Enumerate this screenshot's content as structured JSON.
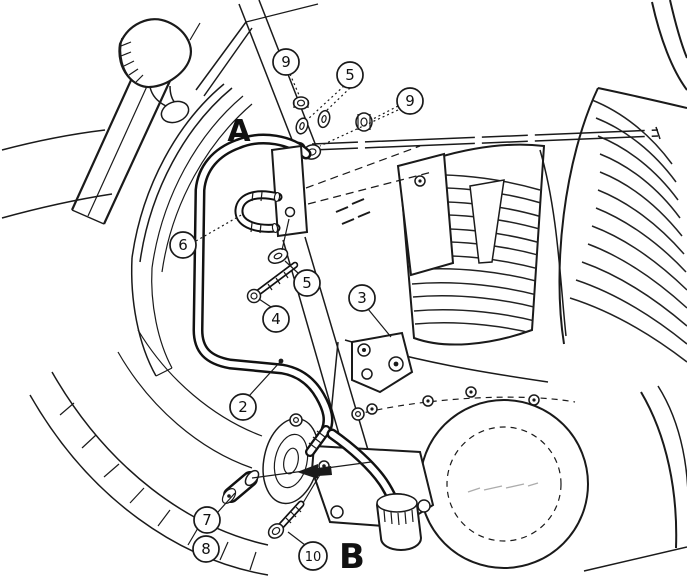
{
  "figure": {
    "section_labels": {
      "a": "A",
      "b": "B"
    },
    "callouts": [
      {
        "number": "9"
      },
      {
        "number": "5"
      },
      {
        "number": "9"
      },
      {
        "number": "6"
      },
      {
        "number": "5"
      },
      {
        "number": "4"
      },
      {
        "number": "3"
      },
      {
        "number": "2"
      },
      {
        "number": "7"
      },
      {
        "number": "8"
      },
      {
        "number": "10"
      }
    ],
    "colors": {
      "ink": "#1a1a1a",
      "paper": "#ffffff"
    }
  }
}
